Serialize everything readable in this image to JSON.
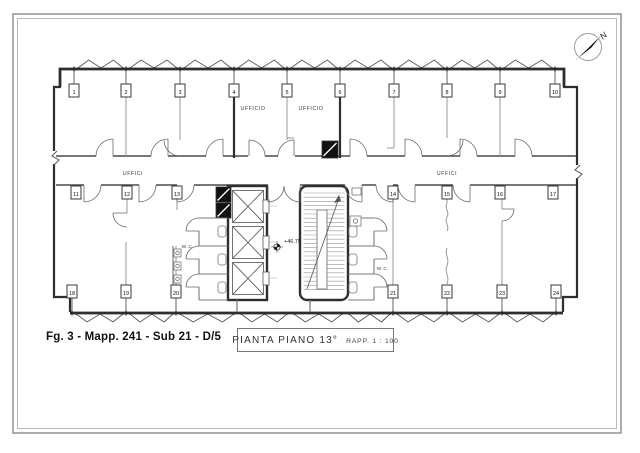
{
  "sheet": {
    "caption": "Fg. 3 - Mapp. 241 - Sub 21 - D/5",
    "title": "PIANTA  PIANO  13°",
    "scale_label": "RAPP.  1 : 100"
  },
  "compass": {
    "label": "N"
  },
  "plan": {
    "room_labels": [
      {
        "text": "UFFICIO",
        "x": 253,
        "y": 110,
        "fs": 5.2
      },
      {
        "text": "UFFICIO",
        "x": 311,
        "y": 110,
        "fs": 5.2
      },
      {
        "text": "UFFICI",
        "x": 133,
        "y": 175,
        "fs": 5.2
      },
      {
        "text": "UFFICI",
        "x": 447,
        "y": 175,
        "fs": 5.2
      },
      {
        "text": "W.C.",
        "x": 188,
        "y": 248,
        "fs": 4.8
      },
      {
        "text": "W.C.",
        "x": 383,
        "y": 270,
        "fs": 4.8
      }
    ],
    "elevation_label": {
      "text": "+46.75",
      "x": 284,
      "y": 243,
      "fs": 5.5
    },
    "window_markers": {
      "top": {
        "box_y": 84,
        "items": [
          {
            "n": "1",
            "x": 74
          },
          {
            "n": "2",
            "x": 126
          },
          {
            "n": "3",
            "x": 180
          },
          {
            "n": "4",
            "x": 234
          },
          {
            "n": "5",
            "x": 287
          },
          {
            "n": "6",
            "x": 340
          },
          {
            "n": "7",
            "x": 394
          },
          {
            "n": "8",
            "x": 447
          },
          {
            "n": "9",
            "x": 500
          },
          {
            "n": "10",
            "x": 555
          }
        ]
      },
      "middle": {
        "box_y": 186,
        "items": [
          {
            "n": "11",
            "x": 76
          },
          {
            "n": "12",
            "x": 127
          },
          {
            "n": "13",
            "x": 177
          },
          {
            "n": "14",
            "x": 393
          },
          {
            "n": "15",
            "x": 447
          },
          {
            "n": "16",
            "x": 500
          },
          {
            "n": "17",
            "x": 553
          }
        ]
      },
      "bottom": {
        "box_y": 285,
        "items": [
          {
            "n": "18",
            "x": 72
          },
          {
            "n": "19",
            "x": 126
          },
          {
            "n": "20",
            "x": 176
          },
          {
            "n": "21",
            "x": 393
          },
          {
            "n": "22",
            "x": 447
          },
          {
            "n": "23",
            "x": 502
          },
          {
            "n": "24",
            "x": 556
          }
        ]
      }
    }
  },
  "colors": {
    "ink": "#2e2e2e",
    "medium": "#555555",
    "light": "#999999",
    "fixture": "#787878"
  }
}
